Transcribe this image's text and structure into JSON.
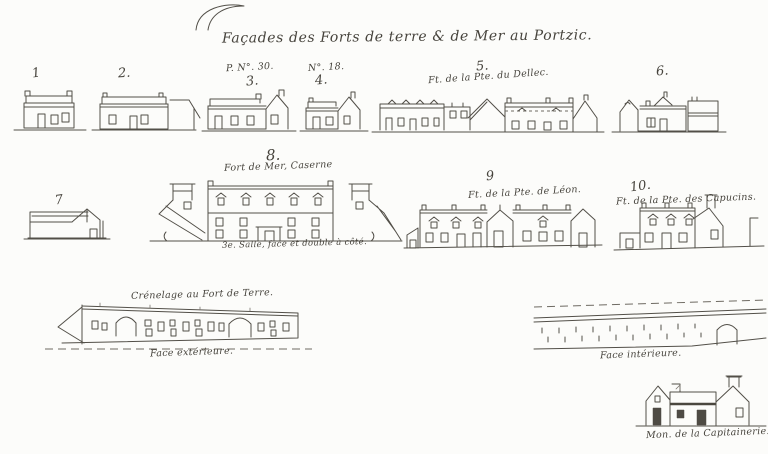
{
  "sheet": {
    "title": "Façades des Forts de terre & de Mer au Portzic.",
    "paper_color": "#fcfcfa",
    "ink_color": "#524f48",
    "facades": [
      {
        "number": "1"
      },
      {
        "number": "2."
      },
      {
        "number": "3.",
        "reference": "P. N°. 30."
      },
      {
        "number": "4.",
        "reference": "N°. 18."
      },
      {
        "number": "5.",
        "caption": "Ft. de la Pte. du Dellec."
      },
      {
        "number": "6."
      },
      {
        "number": "7"
      },
      {
        "number": "8.",
        "caption": "Fort de Mer, Caserne",
        "subcaption": "3e. Salle, face et double à côté."
      },
      {
        "number": "9",
        "caption": "Ft. de la Pte. de Léon."
      },
      {
        "number": "10.",
        "caption": "Ft. de la Pte. des Capucins."
      }
    ],
    "walls": {
      "outer": {
        "caption": "Crénelage au Fort de Terre.",
        "label": "Face extérieure."
      },
      "inner": {
        "label": "Face intérieure."
      }
    },
    "house": {
      "caption": "Mon. de la Capitainerie."
    }
  }
}
